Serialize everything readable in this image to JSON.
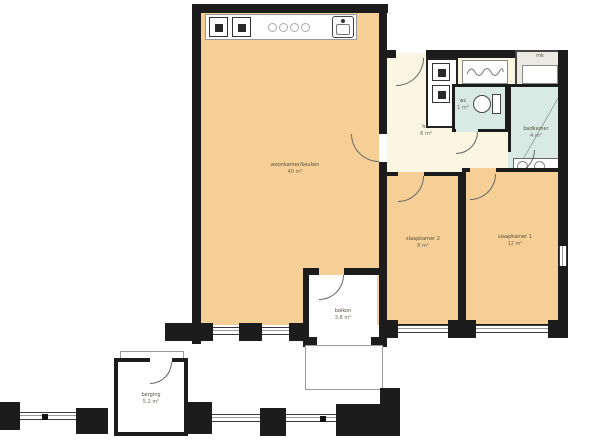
{
  "title": "apartment floor plan",
  "colors": {
    "room-fill": "#f6cf96",
    "hall-fill": "#faf6e1",
    "bath-fill": "#d9eae4",
    "mk-fill": "#eaeae2",
    "wall": "#1c1c1c",
    "outline": "#9b9b9b",
    "text": "#55503f"
  },
  "rooms": {
    "living": {
      "label": "woonkamer/keuken",
      "area": "40 m²"
    },
    "hal": {
      "label": "hal",
      "area": "6 m²"
    },
    "wc": {
      "label": "wc",
      "area": "1 m²"
    },
    "badkamer": {
      "label": "badkamer",
      "area": "4 m²"
    },
    "slaapkamer2": {
      "label": "slaapkamer 2",
      "area": "8 m²"
    },
    "slaapkamer1": {
      "label": "slaapkamer 1",
      "area": "12 m²"
    },
    "balkon": {
      "label": "balkon",
      "area": "3,8 m²"
    },
    "berging": {
      "label": "berging",
      "area": "5,2 m²"
    },
    "mk": {
      "label": "mk"
    }
  },
  "fixtures": {
    "kitchen": [
      "oven",
      "fridge",
      "cooktop",
      "sink"
    ],
    "closet": [
      "washer",
      "dryer"
    ],
    "wc": [
      "toilet"
    ],
    "badkamer": [
      "shower",
      "washbasin"
    ],
    "hal": [
      "cv-unit"
    ]
  }
}
